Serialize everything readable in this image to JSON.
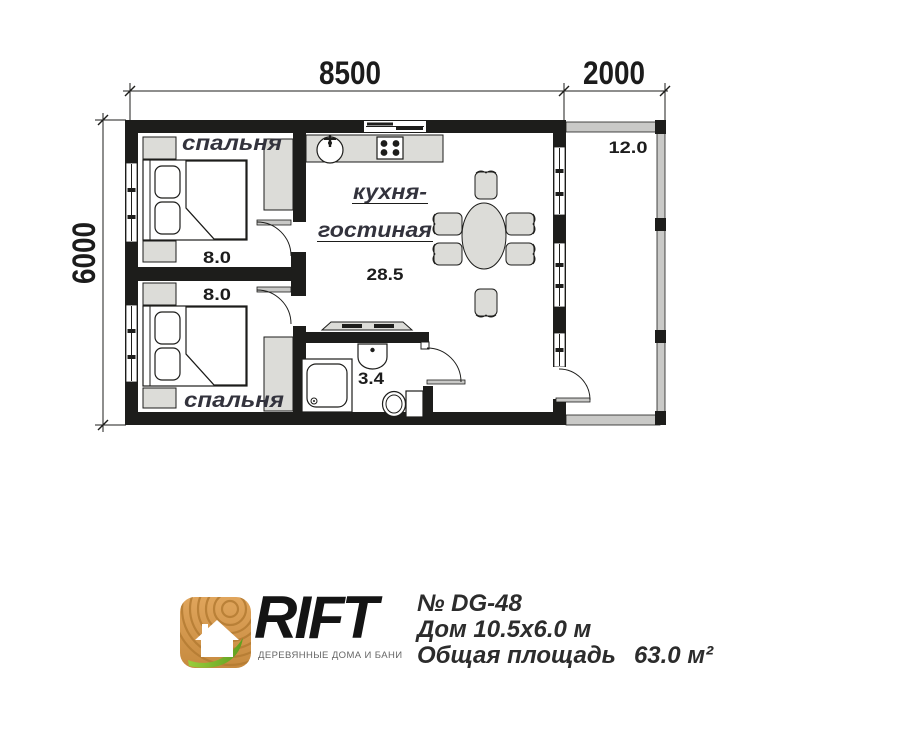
{
  "plan": {
    "dim_top_main": "8500",
    "dim_top_terrace": "2000",
    "dim_left": "6000",
    "bedroom_top": {
      "label": "спальня",
      "area": "8.0"
    },
    "bedroom_bottom": {
      "label": "спальня",
      "area": "8.0"
    },
    "kitchen_living": {
      "label_line1": "кухня-",
      "label_line2": "гостиная",
      "area": "28.5"
    },
    "bathroom": {
      "area": "3.4"
    },
    "terrace": {
      "area": "12.0"
    }
  },
  "footer": {
    "brand": "RIFT",
    "tagline": "ДЕРЕВЯННЫЕ ДОМА И БАНИ",
    "project_number": "№ DG-48",
    "house_size": "Дом 10.5x6.0 м",
    "total_area_label": "Общая площадь",
    "total_area_value": "63.0 м²"
  },
  "colors": {
    "wall": "#1d1d1b",
    "furniture_fill": "#dcdcd8",
    "terrace_rail": "#c9c9c7",
    "logo_wood": "#d69a50",
    "logo_leaf": "#76b82a",
    "brand_text": "#141414"
  }
}
